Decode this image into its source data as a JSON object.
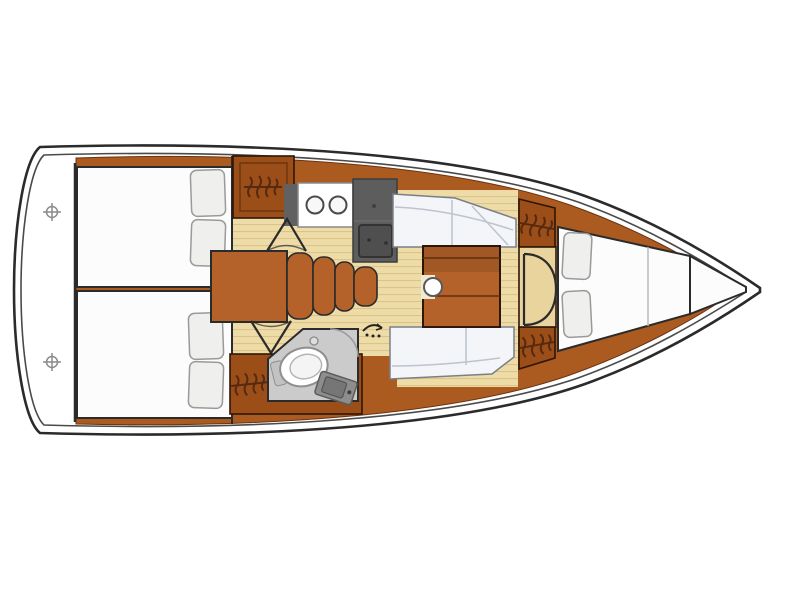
{
  "meta": {
    "kind": "sailboat-interior-floor-plan",
    "orientation": "bow-right-stern-left",
    "text_content": "none — drawing contains no rendered text"
  },
  "colors": {
    "background": "#ffffff",
    "hull-fill": "#ffffff",
    "hull-line": "#2b2b2b",
    "deck-line": "#4a4a4a",
    "wood": "#ab5a20",
    "wood-light": "#b5622a",
    "wood-cabinet": "#9c4e18",
    "wood-edge": "#6b3310",
    "outline": "#2e1608",
    "floor": "#eedca8",
    "floor-line": "#d9c185",
    "berth": "#fcfcfc",
    "pillow": "#efefed",
    "pillow-line": "#9a9a9a",
    "cushion": "#f3f5f8",
    "cushion-edge": "#7a7f87",
    "cushion-line": "#bdc4ce",
    "counter": "#5d5d5d",
    "counter-edge": "#3c3c3c",
    "sink": "#4f4f4f",
    "head-floor": "#cbcbcb",
    "fixture-white": "#ffffff",
    "symbol": "#8a8a8a",
    "hanger": "#4a2410"
  },
  "areas": [
    {
      "id": "transom-deck",
      "icons": [
        "deck-fitting-icon",
        "deck-fitting-icon"
      ]
    },
    {
      "id": "aft-cabin-port",
      "pillows": 2
    },
    {
      "id": "aft-cabin-starboard",
      "pillows": 2
    },
    {
      "id": "galley",
      "fixtures": [
        "two-burner-stove",
        "sink-counter",
        "hanging-locker"
      ]
    },
    {
      "id": "companionway",
      "fixtures": [
        "engine-box",
        "steps-x4",
        "cabin-door",
        "cabin-door"
      ]
    },
    {
      "id": "head",
      "fixtures": [
        "toilet",
        "sink",
        "shower-arc",
        "drain",
        "folding-door-arrow"
      ]
    },
    {
      "id": "saloon",
      "fixtures": [
        "port-settee",
        "starboard-settee",
        "table",
        "table-leg"
      ]
    },
    {
      "id": "forward-passage",
      "fixtures": [
        "hanging-locker-top",
        "hanging-locker-bottom",
        "double-doors"
      ]
    },
    {
      "id": "forward-cabin",
      "pillows": 2,
      "fixtures": [
        "v-berth",
        "anchor-locker"
      ]
    }
  ]
}
